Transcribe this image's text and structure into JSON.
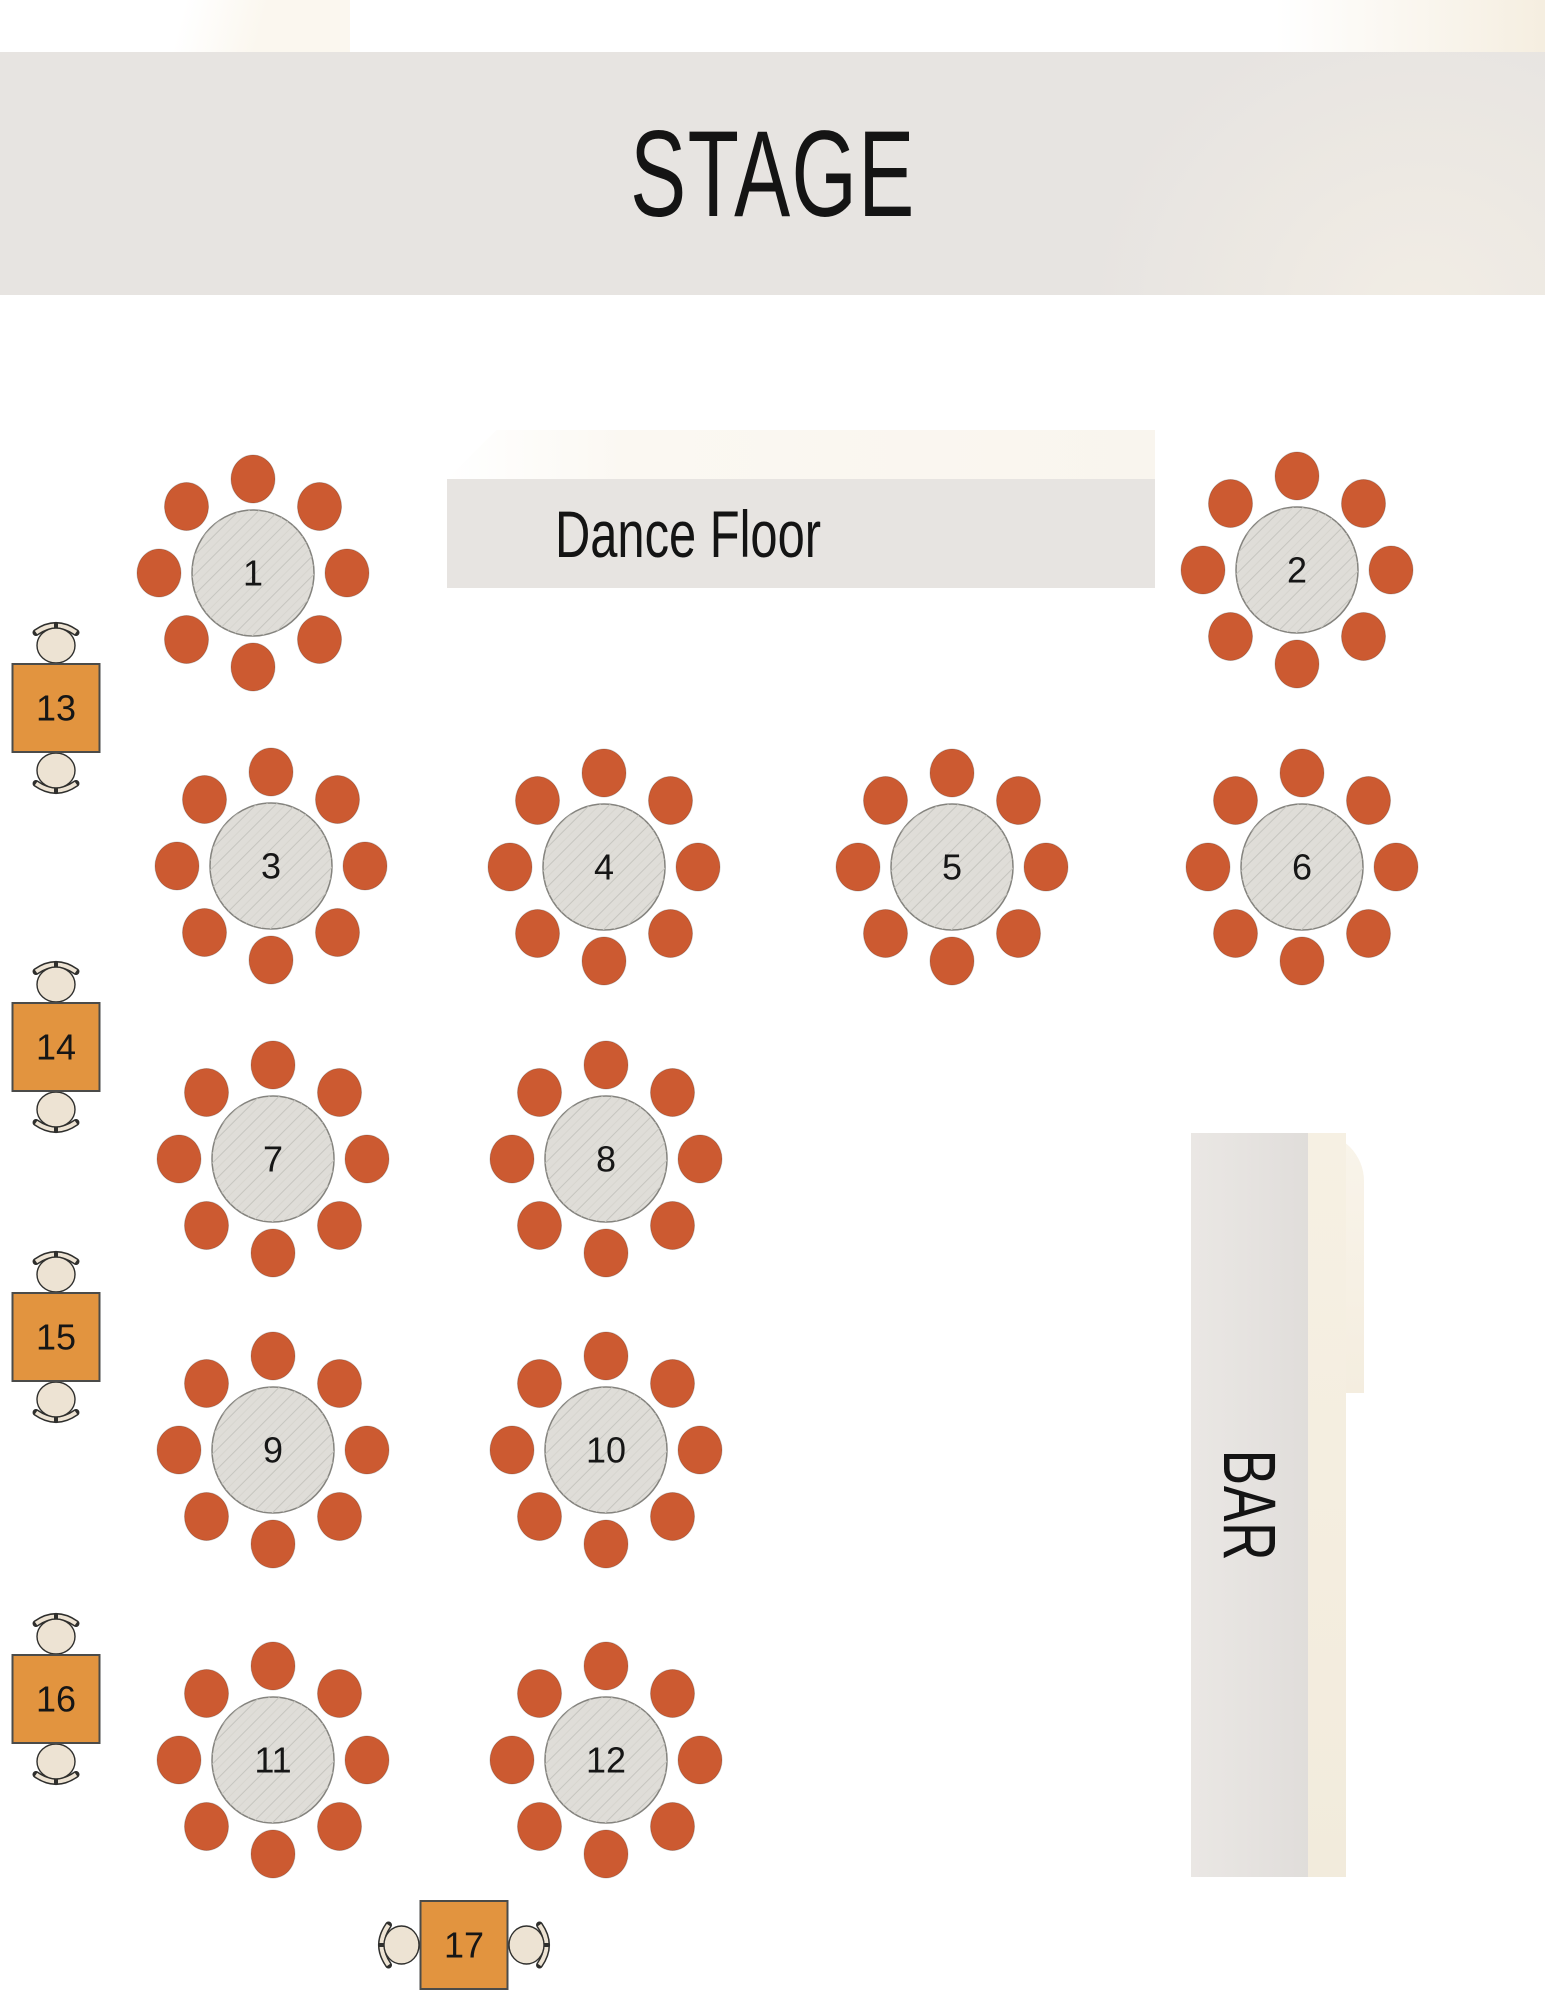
{
  "canvas": {
    "width": 1545,
    "height": 2000
  },
  "areas": {
    "stage": {
      "label": "STAGE",
      "x": 0,
      "y": 52,
      "width": 1545,
      "height": 243
    },
    "dance_floor": {
      "label": "Dance Floor",
      "x": 447,
      "y": 479,
      "width": 708,
      "height": 109
    },
    "bar": {
      "label": "BAR",
      "x": 1191,
      "y": 1133,
      "width": 117,
      "height": 744
    }
  },
  "tables": [
    {
      "number": "1",
      "type": "round",
      "seats": 8,
      "x": 253,
      "y": 573
    },
    {
      "number": "2",
      "type": "round",
      "seats": 8,
      "x": 1297,
      "y": 570
    },
    {
      "number": "3",
      "type": "round",
      "seats": 8,
      "x": 271,
      "y": 866
    },
    {
      "number": "4",
      "type": "round",
      "seats": 8,
      "x": 604,
      "y": 867
    },
    {
      "number": "5",
      "type": "round",
      "seats": 8,
      "x": 952,
      "y": 867
    },
    {
      "number": "6",
      "type": "round",
      "seats": 8,
      "x": 1302,
      "y": 867
    },
    {
      "number": "7",
      "type": "round",
      "seats": 8,
      "x": 273,
      "y": 1159
    },
    {
      "number": "8",
      "type": "round",
      "seats": 8,
      "x": 606,
      "y": 1159
    },
    {
      "number": "9",
      "type": "round",
      "seats": 8,
      "x": 273,
      "y": 1450
    },
    {
      "number": "10",
      "type": "round",
      "seats": 8,
      "x": 606,
      "y": 1450
    },
    {
      "number": "11",
      "type": "round",
      "seats": 8,
      "x": 273,
      "y": 1760
    },
    {
      "number": "12",
      "type": "round",
      "seats": 8,
      "x": 606,
      "y": 1760
    },
    {
      "number": "13",
      "type": "small",
      "seats": 2,
      "orientation": "vertical",
      "x": 56,
      "y": 708
    },
    {
      "number": "14",
      "type": "small",
      "seats": 2,
      "orientation": "vertical",
      "x": 56,
      "y": 1047
    },
    {
      "number": "15",
      "type": "small",
      "seats": 2,
      "orientation": "vertical",
      "x": 56,
      "y": 1337
    },
    {
      "number": "16",
      "type": "small",
      "seats": 2,
      "orientation": "vertical",
      "x": 56,
      "y": 1699
    },
    {
      "number": "17",
      "type": "small",
      "seats": 2,
      "orientation": "horizontal",
      "x": 464,
      "y": 1945
    }
  ],
  "colors": {
    "chair_orange": "#CC5A31",
    "round_table_fill": "#DFDDD8",
    "round_table_stroke": "#84837E",
    "hatch_line": "#C6C5BF",
    "hatch_line_light": "#D4D3CD",
    "small_table_orange": "#E2943F",
    "small_table_stroke": "#4B4B49",
    "cream_chair_fill": "#EDE3D3",
    "cream_chair_outline": "#2F2F2D",
    "banner_fill": "#E7E4E1",
    "banner_text": "#141414",
    "background": "#FFFFFF",
    "background_cream": "#F4EDDF"
  }
}
